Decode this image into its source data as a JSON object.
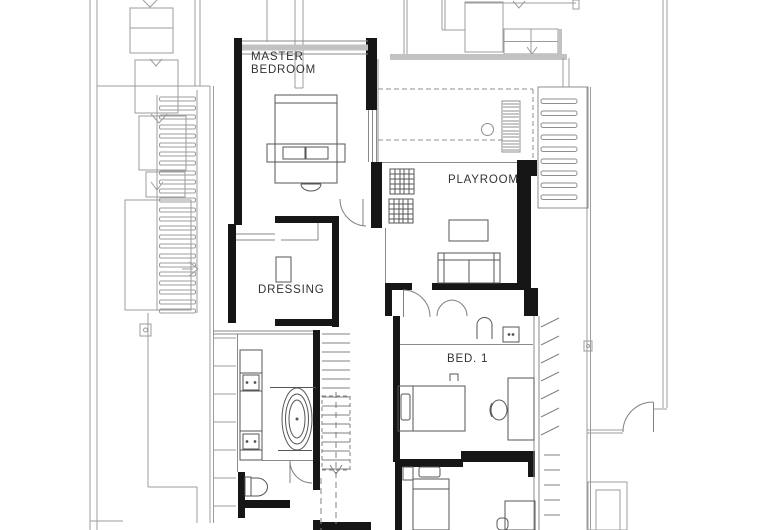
{
  "page": {
    "kind": "architectural floor plan",
    "style": "black and white CAD linework, plan view, upper storey"
  },
  "colors": {
    "background": "#ffffff",
    "walls": "#161616",
    "linework": "#555555",
    "context_lines": "#9c9c9c",
    "shading_band": "#c2c2c2",
    "label_text": "#333333"
  },
  "labels": {
    "master_bedroom_line1": "MASTER",
    "master_bedroom_line2": "BEDROOM",
    "playroom": "PLAYROOM",
    "dressing": "DRESSING",
    "bed_1": "BED. 1"
  },
  "depicted_symbols": [
    "double-bed",
    "foot-bench-with-cushions",
    "ottoman",
    "dressing-island",
    "coffee-table",
    "sofa",
    "floor-grilles",
    "void-ladder",
    "skylight-circle",
    "louvered-roof-slats",
    "bathtub",
    "vanity-with-two-sinks",
    "toilet",
    "hand-basin",
    "appliance-box",
    "staircase-with-down-arrow",
    "door-swings",
    "single-bed",
    "desk-and-chair",
    "balcony-hatching",
    "neighbour-stair-arrows"
  ]
}
